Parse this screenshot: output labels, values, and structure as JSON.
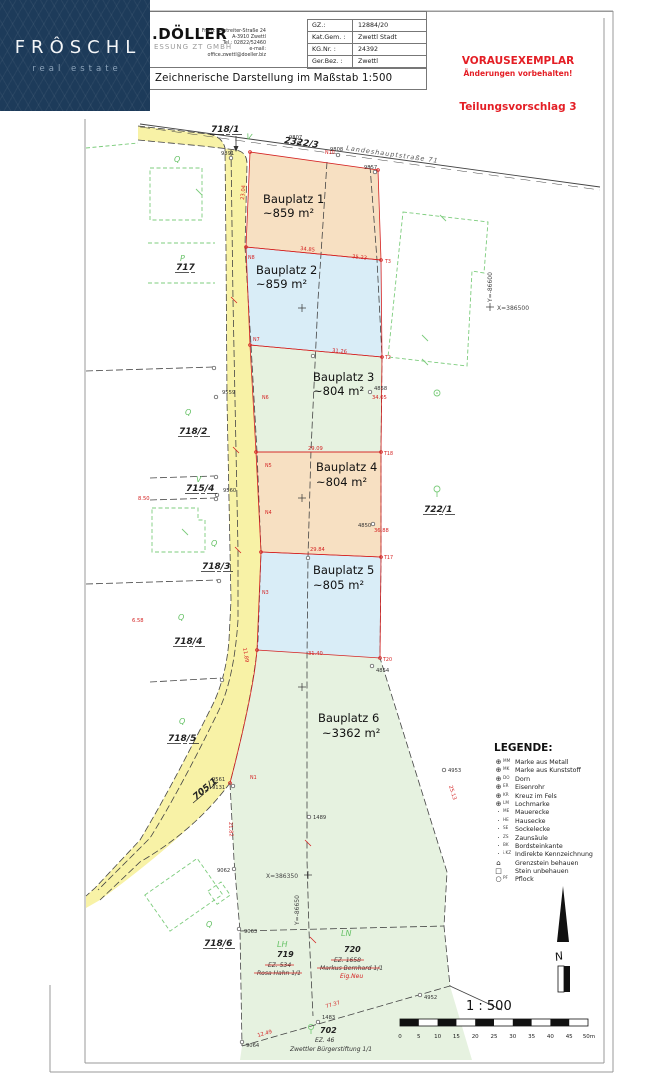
{
  "logo": {
    "brand": "FRÔSCHL",
    "tagline": "real estate"
  },
  "title_block": {
    "company_name": ".DÖLLER",
    "company_sub": "ESSUNG ZT GMBH",
    "address": {
      "l1": "Franz Forstreiter-Straße 24",
      "l2": "A-3910 Zwettl",
      "l3": "Tel.: 02822/52460",
      "l4": "e-mail: office.zwettl@doeller.biz"
    },
    "fields": [
      {
        "label": "GZ.:",
        "value": "12884/20"
      },
      {
        "label": "Kat.Gem. :",
        "value": "Zwettl Stadt"
      },
      {
        "label": "KG.Nr. :",
        "value": "24392"
      },
      {
        "label": "Ger.Bez. :",
        "value": "Zwettl"
      }
    ],
    "subtitle": "Zeichnerische Darstellung im Maßstab 1:500"
  },
  "notices": {
    "stamp1": "VORAUSEXEMPLAR",
    "stamp2": "Änderungen vorbehalten!",
    "proposal": "Teilungsvorschlag 3"
  },
  "map": {
    "street_label": "Landeshauptstraße 71",
    "plots": [
      {
        "name": "Bauplatz 1",
        "area": "~859 m²"
      },
      {
        "name": "Bauplatz 2",
        "area": "~859 m²"
      },
      {
        "name": "Bauplatz 3",
        "area": "~804 m²"
      },
      {
        "name": "Bauplatz 4",
        "area": "~804 m²"
      },
      {
        "name": "Bauplatz 5",
        "area": "~805 m²"
      },
      {
        "name": "Bauplatz 6",
        "area": "~3362 m²"
      }
    ],
    "parcels": {
      "p718_1": "718/1",
      "p2322_3": "2322/3",
      "p717": "717",
      "p718_2": "718/2",
      "p715_4": "715/4",
      "p718_3": "718/3",
      "p718_4": "718/4",
      "p718_5": "718/5",
      "p705_1": "705/1",
      "p718_6": "718/6",
      "p722_1": "722/1",
      "p719": "719",
      "p720": "720",
      "p702": "702"
    },
    "owners": {
      "o719": {
        "ez": "EZ. 534",
        "name": "Rosa Hahn 1/1"
      },
      "o720": {
        "ez": "EZ. 1658",
        "name": "Markus Bernhard 1/1",
        "note": "Eig.Neu"
      },
      "o702": {
        "ez": "EZ. 46",
        "name": "Zwettler Bürgerstiftung 1/1"
      }
    },
    "coords": {
      "x1": "X=386500",
      "y1": "Y=-86600",
      "x2": "X=386350",
      "y2": "Y=-86650"
    },
    "points": [
      "9807",
      "9808",
      "9857",
      "9891",
      "9559",
      "9560",
      "9561",
      "9131",
      "9062",
      "9063",
      "9064",
      "4850",
      "4858",
      "4854",
      "4953",
      "4952",
      "1489",
      "1483"
    ],
    "dims": [
      "23.04",
      "34.85",
      "35.23",
      "31.26",
      "29.09",
      "29.84",
      "31.40",
      "34.05",
      "36.88",
      "25.13",
      "21.82",
      "11.89",
      "8.50",
      "6.58",
      "77.37",
      "12.49"
    ],
    "npoints": [
      "N10",
      "N8",
      "N7",
      "N6",
      "N5",
      "N4",
      "N3",
      "N1"
    ],
    "tpoints": [
      "T3",
      "T2",
      "T18",
      "T17",
      "T20"
    ],
    "veg": {
      "q": "Q",
      "p": "P",
      "v": "V",
      "lh": "LH",
      "ln": "LN"
    }
  },
  "legend": {
    "title": "LEGENDE:",
    "items": [
      {
        "sym": "⊕",
        "code": "MM",
        "label": "Marke aus Metall"
      },
      {
        "sym": "⊕",
        "code": "MK",
        "label": "Marke aus Kunststoff"
      },
      {
        "sym": "⊕",
        "code": "DO",
        "label": "Dorn"
      },
      {
        "sym": "⊕",
        "code": "ER",
        "label": "Eisenrohr"
      },
      {
        "sym": "⊕",
        "code": "KR",
        "label": "Kreuz im Fels"
      },
      {
        "sym": "⊕",
        "code": "LM",
        "label": "Lochmarke"
      },
      {
        "sym": "·",
        "code": "ME",
        "label": "Mauerecke"
      },
      {
        "sym": "·",
        "code": "HE",
        "label": "Hausecke"
      },
      {
        "sym": "·",
        "code": "SE",
        "label": "Sockelecke"
      },
      {
        "sym": "·",
        "code": "ZS",
        "label": "Zaunsäule"
      },
      {
        "sym": "·",
        "code": "BK",
        "label": "Bordsteinkante"
      },
      {
        "sym": "·",
        "code": "i.KZ",
        "label": "Indirekte Kennzeichnung"
      },
      {
        "sym": "⌂",
        "code": "",
        "label": "Grenzstein behauen"
      },
      {
        "sym": "□",
        "code": "",
        "label": "Stein unbehauen"
      },
      {
        "sym": "○",
        "code": "PF",
        "label": "Pflock"
      }
    ]
  },
  "scale": {
    "title": "1 : 500",
    "ticks": [
      "0",
      "5",
      "10",
      "15",
      "20",
      "25",
      "30",
      "35",
      "40",
      "45",
      "50m"
    ]
  },
  "compass": {
    "letter": "N"
  }
}
